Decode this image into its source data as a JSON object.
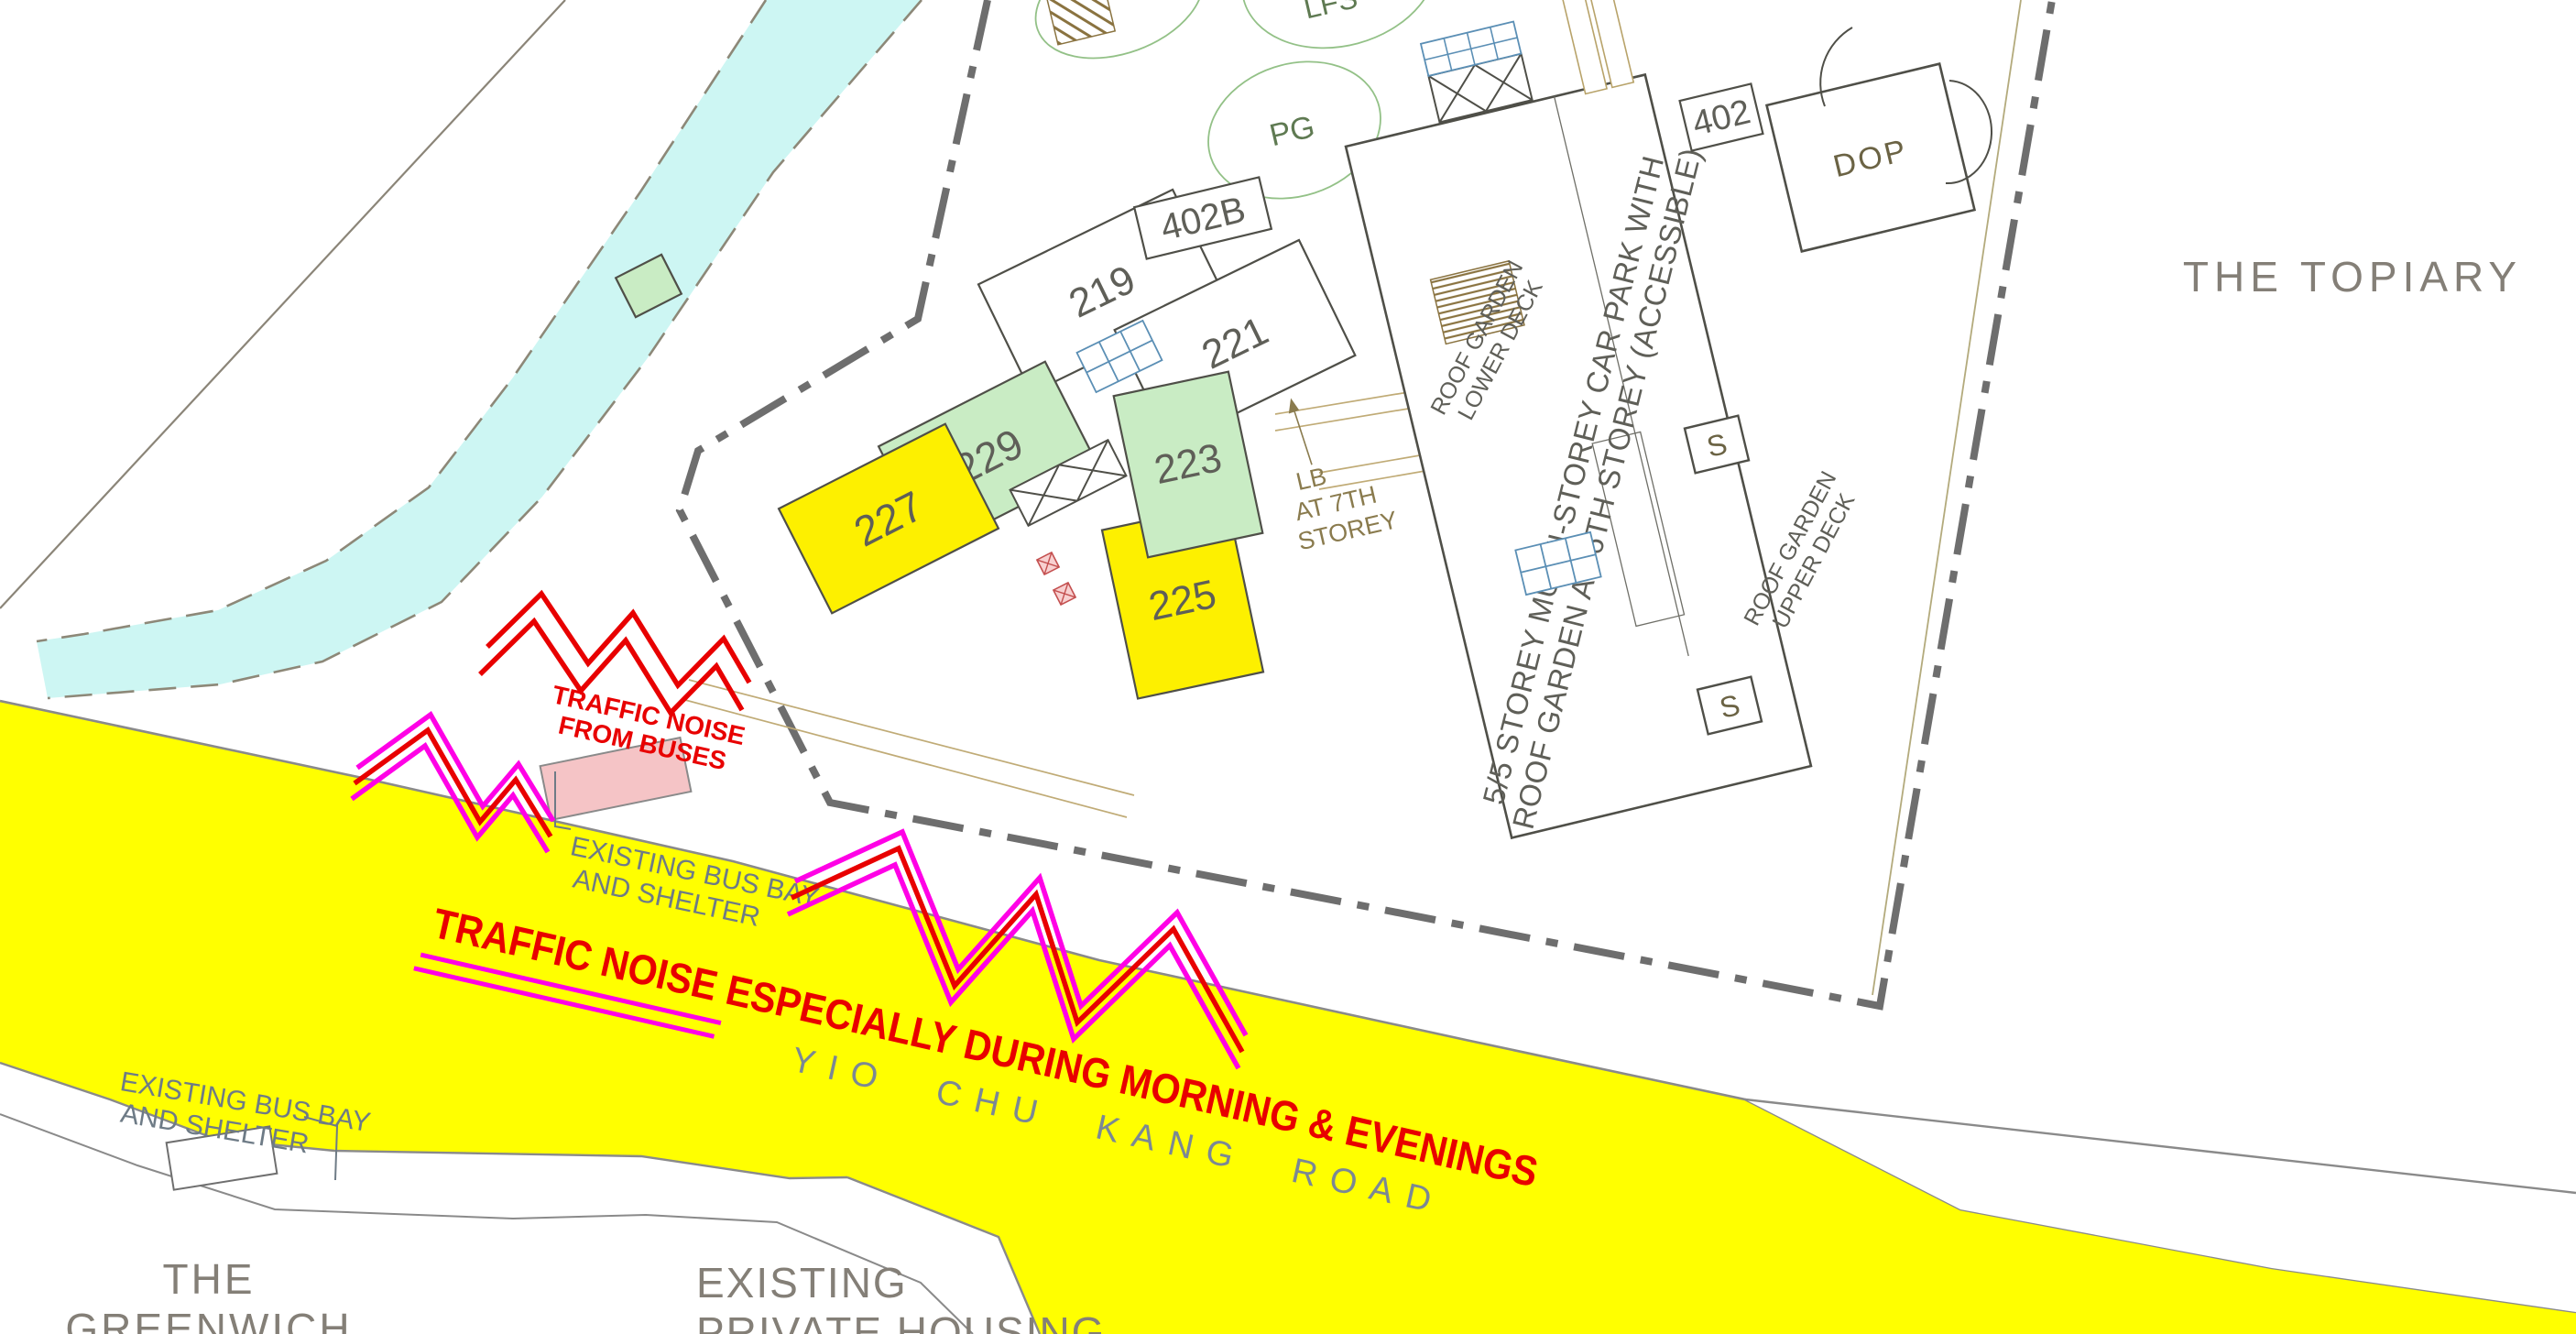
{
  "colors": {
    "road_yellow": "#ffff00",
    "block_yellow": "#fdf000",
    "block_green": "#c9ecc4",
    "canal_cyan": "#cdf6f3",
    "annotation_red": "#e80000",
    "annotation_magenta": "#ff00e6",
    "shelter_pink": "#f5c4c6",
    "boundary_gray": "#6e6e6e",
    "names_gray": "#847f77",
    "road_name_gray": "#7b8894"
  },
  "annotations": {
    "traffic_noise_main": "TRAFFIC NOISE ESPECIALLY DURING MORNING & EVENINGS",
    "traffic_noise_buses_line1": "TRAFFIC NOISE",
    "traffic_noise_buses_line2": "FROM BUSES",
    "bus_bay_line1": "EXISTING BUS BAY",
    "bus_bay_line2": "AND SHELTER"
  },
  "roads": {
    "yio_chu_kang": "YIO CHU KANG ROAD"
  },
  "places": {
    "topiary": "THE TOPIARY",
    "greenwich_line1": "THE",
    "greenwich_line2": "GREENWICH",
    "private_housing_line1": "EXISTING",
    "private_housing_line2": "PRIVATE HOUSING"
  },
  "blocks": {
    "b219": "219",
    "b221": "221",
    "b223": "223",
    "b225": "225",
    "b227": "227",
    "b229": "229",
    "b402": "402",
    "b402b": "402B",
    "dop": "DOP"
  },
  "site": {
    "carpark_line1": "5/5 STOREY MULTI-STOREY CAR PARK WITH",
    "carpark_line2": "ROOF GARDEN AT 6TH STOREY (ACCESSIBLE)",
    "roof_garden": "ROOF GARDEN",
    "lower_deck": "LOWER DECK",
    "upper_deck": "UPPER DECK",
    "lb_line1": "LB",
    "lb_line2": "AT 7TH",
    "lb_line3": "STOREY",
    "stair": "S",
    "playground": "PG",
    "landscape_feature": "LFS"
  }
}
